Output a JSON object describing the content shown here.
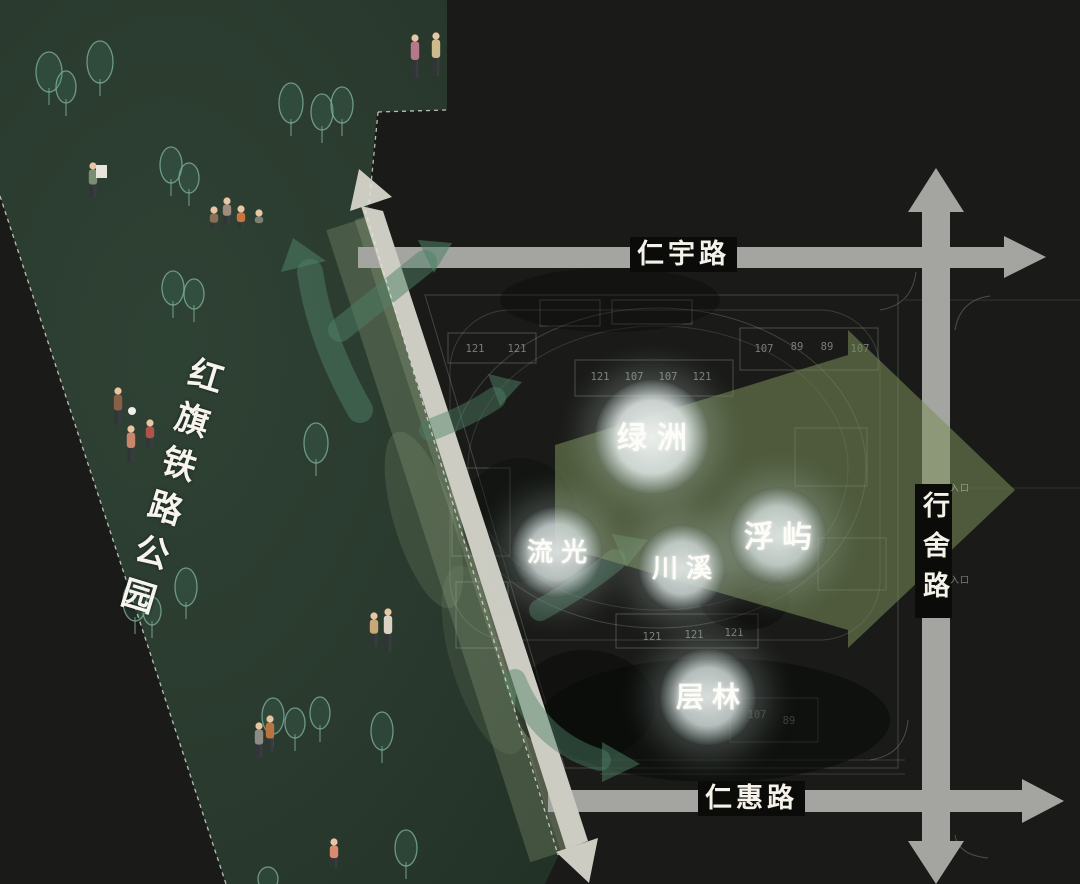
{
  "park": {
    "name": "红旗铁路公园"
  },
  "roads": {
    "top": {
      "label": "仁宇路"
    },
    "right": {
      "label": "行舍路"
    },
    "bottom": {
      "label": "仁惠路"
    }
  },
  "zones": [
    {
      "id": "lvzhou",
      "label": "绿洲",
      "x": 652,
      "y": 437,
      "r": 57,
      "fs": 30,
      "ls": 10,
      "bright": true
    },
    {
      "id": "liuguang",
      "label": "流光",
      "x": 557,
      "y": 552,
      "r": 46,
      "fs": 26,
      "ls": 8,
      "bright": false
    },
    {
      "id": "chuanxi",
      "label": "川溪",
      "x": 682,
      "y": 568,
      "r": 44,
      "fs": 26,
      "ls": 8,
      "bright": false
    },
    {
      "id": "fuyu",
      "label": "浮屿",
      "x": 778,
      "y": 536,
      "r": 49,
      "fs": 30,
      "ls": 8,
      "bright": false
    },
    {
      "id": "cenglin",
      "label": "层林",
      "x": 708,
      "y": 697,
      "r": 49,
      "fs": 28,
      "ls": 8,
      "bright": false
    }
  ],
  "site_plan": {
    "building_numbers": [
      {
        "x": 475,
        "y": 352,
        "n": "121"
      },
      {
        "x": 517,
        "y": 352,
        "n": "121"
      },
      {
        "x": 600,
        "y": 380,
        "n": "121"
      },
      {
        "x": 634,
        "y": 380,
        "n": "107"
      },
      {
        "x": 668,
        "y": 380,
        "n": "107"
      },
      {
        "x": 702,
        "y": 380,
        "n": "121"
      },
      {
        "x": 764,
        "y": 352,
        "n": "107"
      },
      {
        "x": 797,
        "y": 350,
        "n": "89"
      },
      {
        "x": 827,
        "y": 350,
        "n": "89"
      },
      {
        "x": 860,
        "y": 352,
        "n": "107"
      },
      {
        "x": 652,
        "y": 640,
        "n": "121"
      },
      {
        "x": 694,
        "y": 638,
        "n": "121"
      },
      {
        "x": 734,
        "y": 636,
        "n": "121"
      },
      {
        "x": 757,
        "y": 718,
        "n": "107"
      },
      {
        "x": 789,
        "y": 724,
        "n": "89"
      }
    ],
    "entrances": [
      {
        "label": "入口",
        "x": 950,
        "y": 481
      },
      {
        "label": "入口",
        "x": 950,
        "y": 573
      }
    ]
  },
  "park_scene": {
    "trees": [
      [
        49,
        72,
        13,
        20
      ],
      [
        66,
        87,
        10,
        16
      ],
      [
        100,
        62,
        13,
        21
      ],
      [
        171,
        165,
        11,
        18
      ],
      [
        189,
        178,
        10,
        15
      ],
      [
        291,
        103,
        12,
        20
      ],
      [
        322,
        112,
        11,
        18
      ],
      [
        342,
        105,
        11,
        18
      ],
      [
        173,
        288,
        11,
        17
      ],
      [
        194,
        294,
        10,
        15
      ],
      [
        316,
        443,
        12,
        20
      ],
      [
        135,
        601,
        12,
        20
      ],
      [
        152,
        611,
        9,
        14
      ],
      [
        186,
        587,
        11,
        19
      ],
      [
        273,
        716,
        11,
        18
      ],
      [
        295,
        723,
        10,
        15
      ],
      [
        320,
        713,
        10,
        16
      ],
      [
        382,
        731,
        11,
        19
      ],
      [
        406,
        848,
        11,
        18
      ],
      [
        268,
        879,
        10,
        12
      ]
    ],
    "people": [
      {
        "x": 415,
        "y": 78,
        "h": 44,
        "c": "#b5798a"
      },
      {
        "x": 436,
        "y": 76,
        "h": 44,
        "c": "#cdbb8c"
      },
      {
        "x": 93,
        "y": 198,
        "h": 36,
        "c": "#7c8e72"
      },
      {
        "x": 214,
        "y": 228,
        "h": 22,
        "c": "#8a6f58"
      },
      {
        "x": 227,
        "y": 224,
        "h": 27,
        "c": "#9c8d7d"
      },
      {
        "x": 241,
        "y": 228,
        "h": 23,
        "c": "#c8743d"
      },
      {
        "x": 259,
        "y": 225,
        "h": 16,
        "c": "#7a8172"
      },
      {
        "x": 118,
        "y": 425,
        "h": 38,
        "c": "#8a5f45"
      },
      {
        "x": 131,
        "y": 462,
        "h": 37,
        "c": "#c8876b"
      },
      {
        "x": 150,
        "y": 447,
        "h": 28,
        "c": "#b05348"
      },
      {
        "x": 374,
        "y": 646,
        "h": 34,
        "c": "#c9a878"
      },
      {
        "x": 388,
        "y": 652,
        "h": 44,
        "c": "#dad2c2"
      },
      {
        "x": 259,
        "y": 758,
        "h": 36,
        "c": "#8c8c84"
      },
      {
        "x": 270,
        "y": 753,
        "h": 38,
        "c": "#b9743f"
      },
      {
        "x": 334,
        "y": 868,
        "h": 30,
        "c": "#d88a72"
      }
    ],
    "props": {
      "ball": {
        "x": 132,
        "y": 411,
        "r": 4
      },
      "board": {
        "x": 96,
        "y": 165,
        "w": 11,
        "h": 13
      }
    }
  },
  "colors": {
    "background": "#1a1b18",
    "park_green": "#2b3b2e",
    "road_gray": "#a4a5a0",
    "road_light": "#ccccc3",
    "arrow_teal": "#4e8066",
    "arrow_olive": "#7a8e5a",
    "glow": "#dfe4e1",
    "label_text": "#f5f3ec",
    "tree_outline": "#7fae9b",
    "cad_line": "#9aa89b"
  }
}
